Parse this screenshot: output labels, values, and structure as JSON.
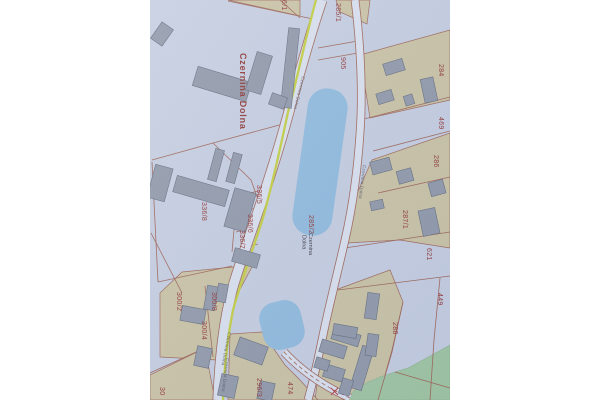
{
  "map": {
    "place_label": "Czernina Dolna",
    "street_name": "Czernina Dolna",
    "combined_label": {
      "parcel": "285/2",
      "name_line1": "Czernina",
      "name_line2": "Dolna"
    },
    "parcel_labels": [
      "285/1",
      "905",
      "284",
      "469",
      "286",
      "287/1",
      "621",
      "449",
      "288",
      "336/5",
      "336/8",
      "336/6",
      "336/7",
      "300/2",
      "300/8",
      "300/4",
      "296/3",
      "474"
    ],
    "partial_labels": [
      "6/1",
      "30"
    ],
    "colors": {
      "paper": "#c6cfe2",
      "road_fill": "#dde4f1",
      "road_edge": "#9a5a48",
      "cycleway_accent": "#c3d02e",
      "water": "#8abade",
      "vegetation": "#9cc69b",
      "built_up_area": "#cbc39e",
      "building": "#8b94a4",
      "parcel_number_text": "#8e2723",
      "marker": "#b03030"
    }
  }
}
